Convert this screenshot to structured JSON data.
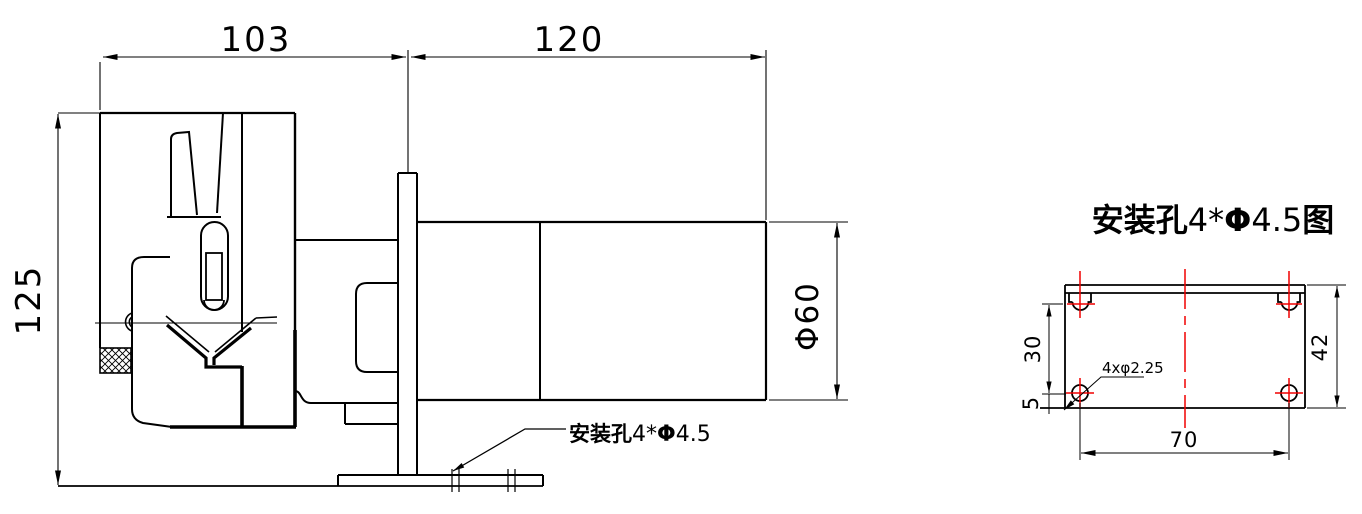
{
  "side_view": {
    "dimensions": {
      "head_width": "103",
      "motor_length": "120",
      "overall_height": "125",
      "motor_diameter": "Φ60"
    },
    "leader": {
      "prefix": "安装孔",
      "count": "4*",
      "phi": "Φ",
      "size": "4.5"
    }
  },
  "hole_diagram": {
    "title": {
      "prefix": "安装孔",
      "count": "4*",
      "phi": "Φ",
      "size": "4.5",
      "suffix": "图"
    },
    "dimensions": {
      "hole_row_spacing": "30",
      "bottom_edge_offset": "5",
      "plate_height": "42",
      "hole_column_spacing": "70"
    },
    "leader_label": "4xφ2.25"
  },
  "colors": {
    "line": "#000000",
    "centerline_red": "#f00000",
    "background": "#ffffff"
  }
}
